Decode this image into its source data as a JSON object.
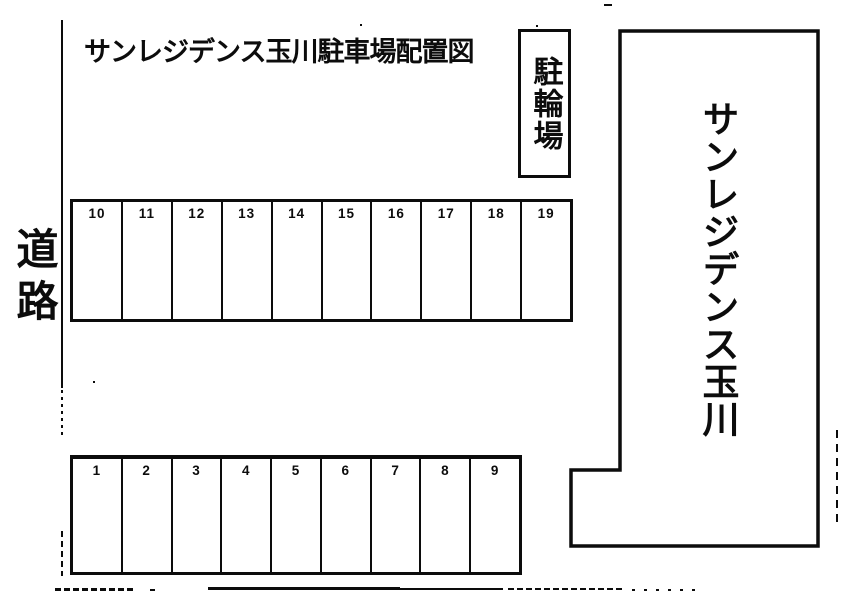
{
  "page": {
    "title": "サンレジデンス玉川駐車場配置図"
  },
  "colors": {
    "ink": "#0c0c0c",
    "paper": "#ffffff"
  },
  "labels": {
    "road": "道路",
    "bicycle_parking": "駐輪場",
    "building_name": "サンレジデンス玉川"
  },
  "parking_rows": {
    "top": {
      "spaces": [
        "10",
        "11",
        "12",
        "13",
        "14",
        "15",
        "16",
        "17",
        "18",
        "19"
      ]
    },
    "bottom": {
      "spaces": [
        "1",
        "2",
        "3",
        "4",
        "5",
        "6",
        "7",
        "8",
        "9"
      ]
    }
  }
}
